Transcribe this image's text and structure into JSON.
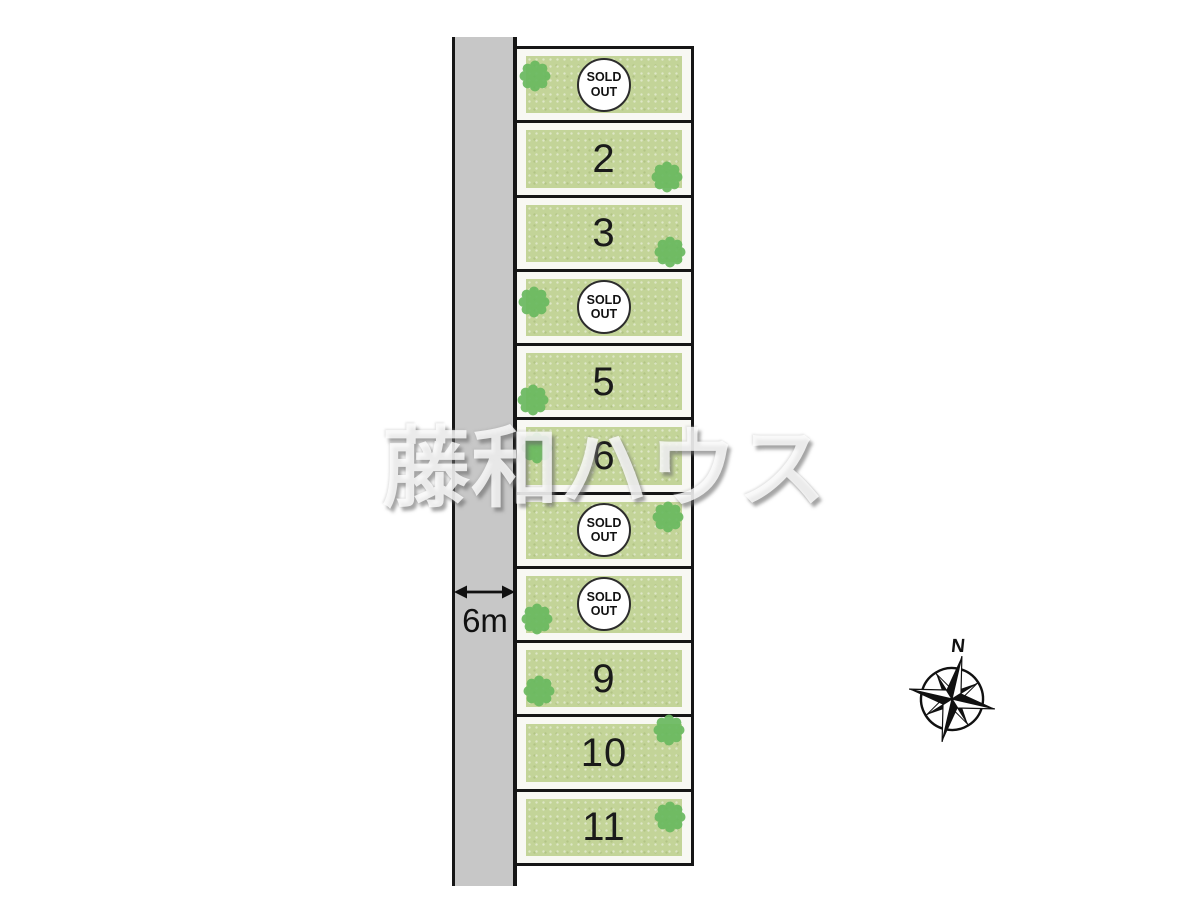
{
  "watermark": {
    "text": "藤和ハウス"
  },
  "road": {
    "width_label": "6m"
  },
  "compass": {
    "north_label": "N"
  },
  "lots": [
    {
      "name": "lot-1",
      "sold_text": "SOLD OUT"
    },
    {
      "name": "lot-2",
      "number": "2"
    },
    {
      "name": "lot-3",
      "number": "3"
    },
    {
      "name": "lot-4",
      "sold_text": "SOLD OUT"
    },
    {
      "name": "lot-5",
      "number": "5"
    },
    {
      "name": "lot-6",
      "number": "6"
    },
    {
      "name": "lot-7",
      "sold_text": "SOLD OUT"
    },
    {
      "name": "lot-8",
      "sold_text": "SOLD OUT"
    },
    {
      "name": "lot-9",
      "number": "9"
    },
    {
      "name": "lot-10",
      "number": "10"
    },
    {
      "name": "lot-11",
      "number": "11"
    }
  ],
  "colors": {
    "lot_green": "#c3d498",
    "road_gray": "#c7c7c7",
    "tree_green": "#69b95f",
    "line_black": "#161616"
  }
}
